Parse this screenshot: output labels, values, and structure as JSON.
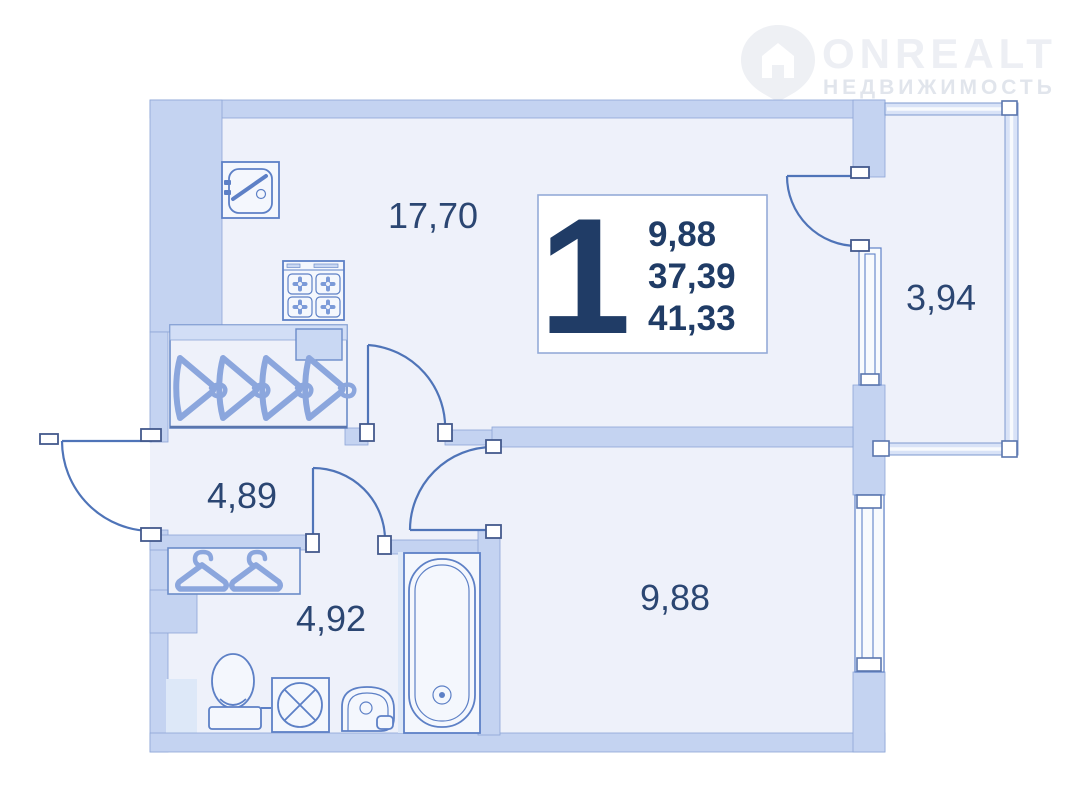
{
  "watermark": {
    "brand": "ONREALT",
    "subtitle": "НЕДВИЖИМОСТЬ",
    "icon": "house-pin-icon"
  },
  "info_box": {
    "rooms_number": "1",
    "areas": [
      "9,88",
      "37,39",
      "41,33"
    ]
  },
  "rooms": [
    {
      "name": "kitchen-living-room",
      "area_label": "17,70"
    },
    {
      "name": "balcony",
      "area_label": "3,94"
    },
    {
      "name": "hallway",
      "area_label": "4,89"
    },
    {
      "name": "bathroom",
      "area_label": "4,92"
    },
    {
      "name": "bedroom",
      "area_label": "9,88"
    }
  ],
  "fixtures": [
    "kitchen-sink",
    "stove",
    "wardrobe-4-hangers",
    "wardrobe-2-hangers",
    "toilet",
    "washing-machine",
    "bathroom-sink",
    "bathtub"
  ],
  "colors": {
    "wall_fill": "#c4d3f1",
    "room_fill": "#eef1fa",
    "outline": "#4f74b8",
    "label_text": "#2b4672",
    "watermark_text": "#edeff4"
  }
}
